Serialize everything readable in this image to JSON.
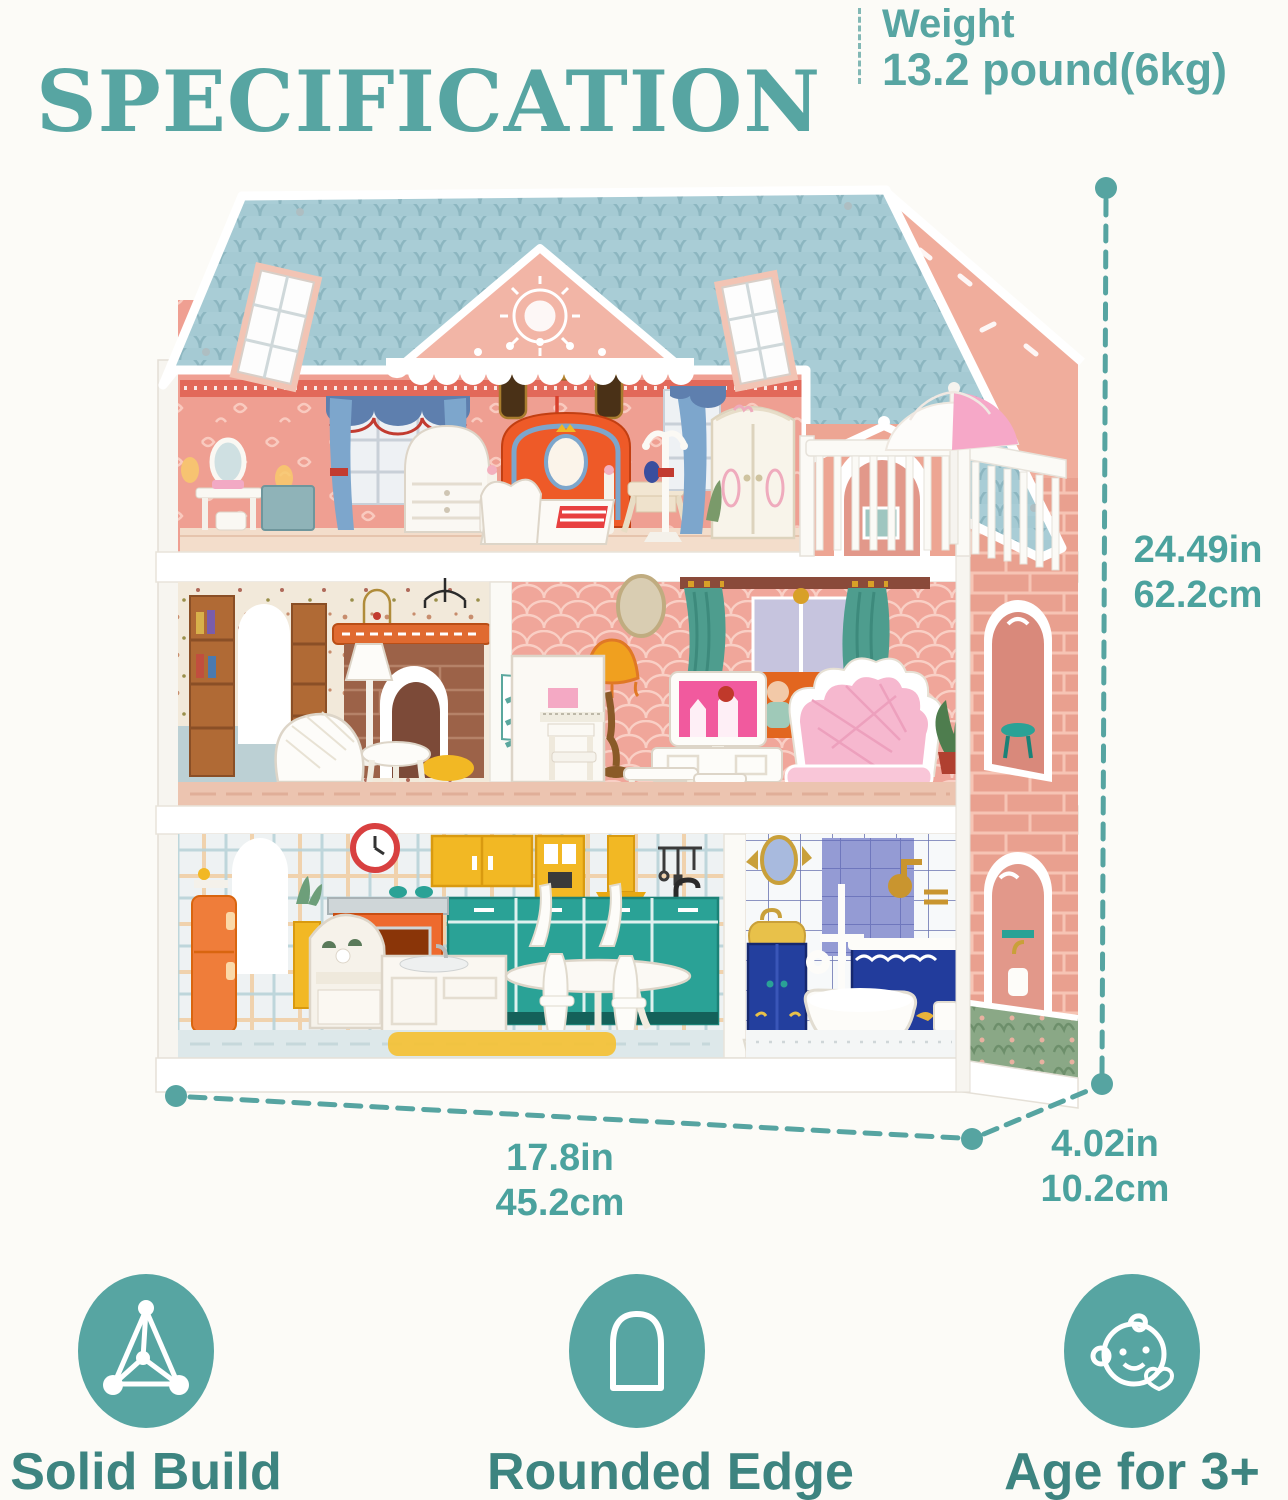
{
  "header": {
    "title": "SPECIFICATION",
    "weight_label": "Weight",
    "weight_value": "13.2 pound(6kg)"
  },
  "dimensions": {
    "height": {
      "inches": "24.49in",
      "metric": "62.2cm"
    },
    "width": {
      "inches": "17.8in",
      "metric": "45.2cm"
    },
    "depth": {
      "inches": "4.02in",
      "metric": "10.2cm"
    }
  },
  "features": [
    {
      "label": "Solid Build",
      "icon": "tetrahedron-icon"
    },
    {
      "label": "Rounded Edge",
      "icon": "arch-icon"
    },
    {
      "label": "Age for 3+",
      "icon": "baby-face-icon"
    }
  ],
  "illustration": {
    "subject": "three-story wooden dollhouse with furniture, balcony and umbrella"
  },
  "palette": {
    "accent_teal": "#57a5a2",
    "accent_dark_teal": "#3d8480",
    "roof_blue": "#a9cdd6",
    "gable_pink": "#f2b5a6",
    "wall_pink": "#ef9f92",
    "brick_side": "#e9a08f",
    "kitchen_teal": "#2aa296",
    "furniture_white": "#faf8f3",
    "orange_accent": "#ee6a2e",
    "yellow_accent": "#f2b824",
    "green_band": "#8aa886"
  }
}
